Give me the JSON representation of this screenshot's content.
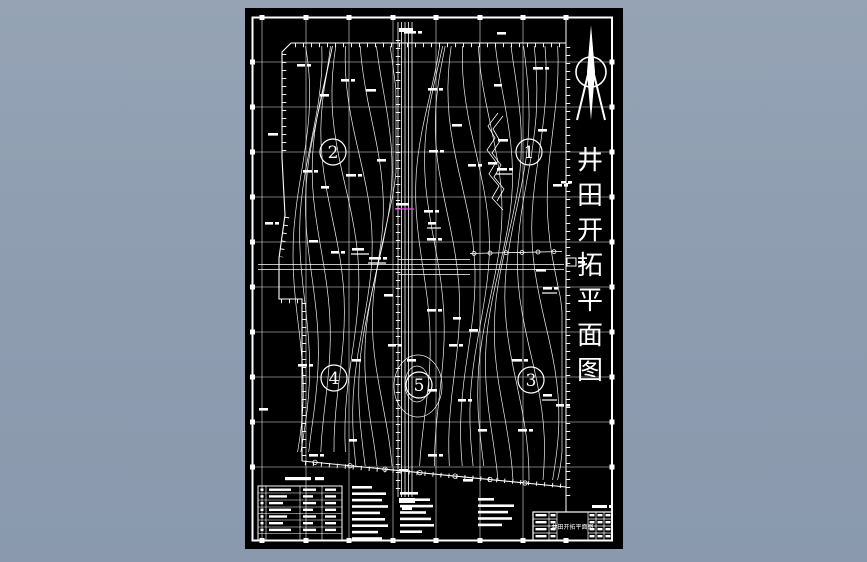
{
  "colors": {
    "page_background": "#8e9cb0",
    "canvas_background": "#000000",
    "line": "#ffffff",
    "accent_magenta": "#ee44ee"
  },
  "drawing": {
    "side_title": "井田开拓平面图",
    "side_title_chars": [
      "井",
      "田",
      "开",
      "拓",
      "平",
      "面",
      "图"
    ],
    "station_labels": [
      "1",
      "2",
      "3",
      "4",
      "5"
    ],
    "north_arrow": "north-arrow",
    "title_block": {
      "drawing_name": "井田开拓平面图"
    }
  }
}
